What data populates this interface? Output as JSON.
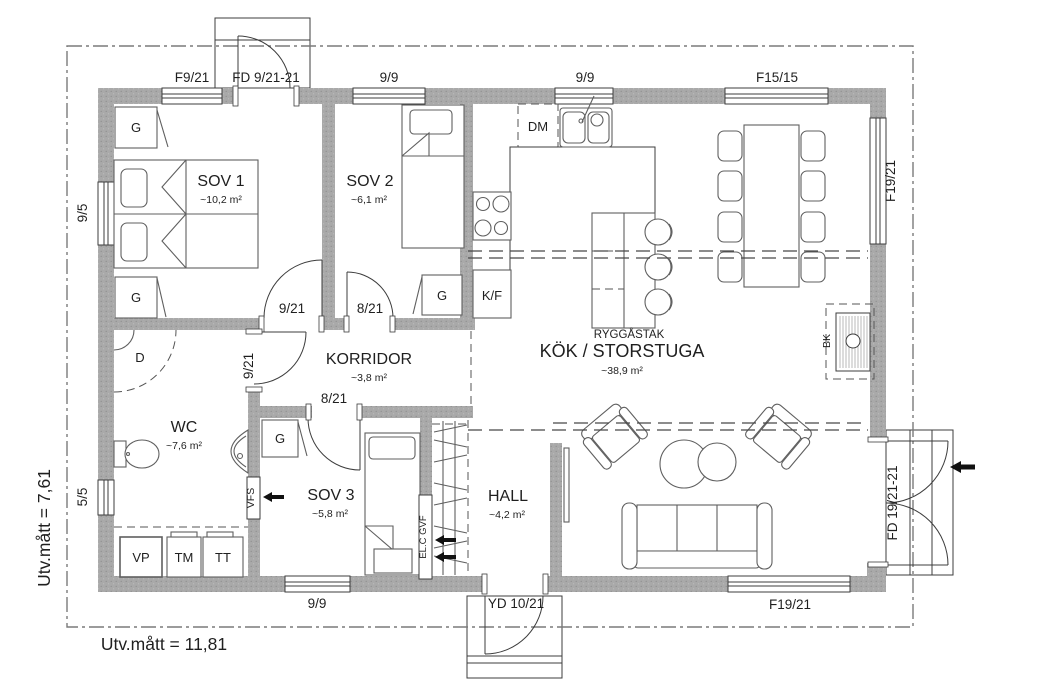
{
  "site": {
    "width_label": "Utv.mått = 11,81",
    "height_label": "Utv.mått = 7,61"
  },
  "rooms": {
    "sov1": {
      "name": "SOV 1",
      "area": "~10,2 m²"
    },
    "sov2": {
      "name": "SOV 2",
      "area": "~6,1 m²"
    },
    "sov3": {
      "name": "SOV 3",
      "area": "~5,8 m²"
    },
    "wc": {
      "name": "WC",
      "area": "~7,6 m²"
    },
    "korridor": {
      "name": "KORRIDOR",
      "area": "~3,8 m²"
    },
    "hall": {
      "name": "HALL",
      "area": "~4,2 m²"
    },
    "kok": {
      "name": "KÖK / STORSTUGA",
      "area": "~38,9 m²",
      "ceiling": "RYGGÅSTAK"
    }
  },
  "openings": {
    "f9_21": "F9/21",
    "fd9_21": "FD 9/21-21",
    "w9_9": "9/9",
    "f15_15": "F15/15",
    "f19_21": "F19/21",
    "w9_5": "9/5",
    "w5_5": "5/5",
    "fd19_21": "FD 19/21-21",
    "yd10_21": "YD 10/21",
    "d9_21": "9/21",
    "d8_21": "8/21"
  },
  "fixtures": {
    "g": "G",
    "d": "D",
    "dm": "DM",
    "kf": "K/F",
    "vp": "VP",
    "tm": "TM",
    "tt": "TT",
    "bk": "BK",
    "vfs": "VFS",
    "el": "EL.C GVF"
  },
  "colors": {
    "wall": "#a9a9a9",
    "line": "#3c3c3c",
    "boundary": "#7a7a7a"
  }
}
